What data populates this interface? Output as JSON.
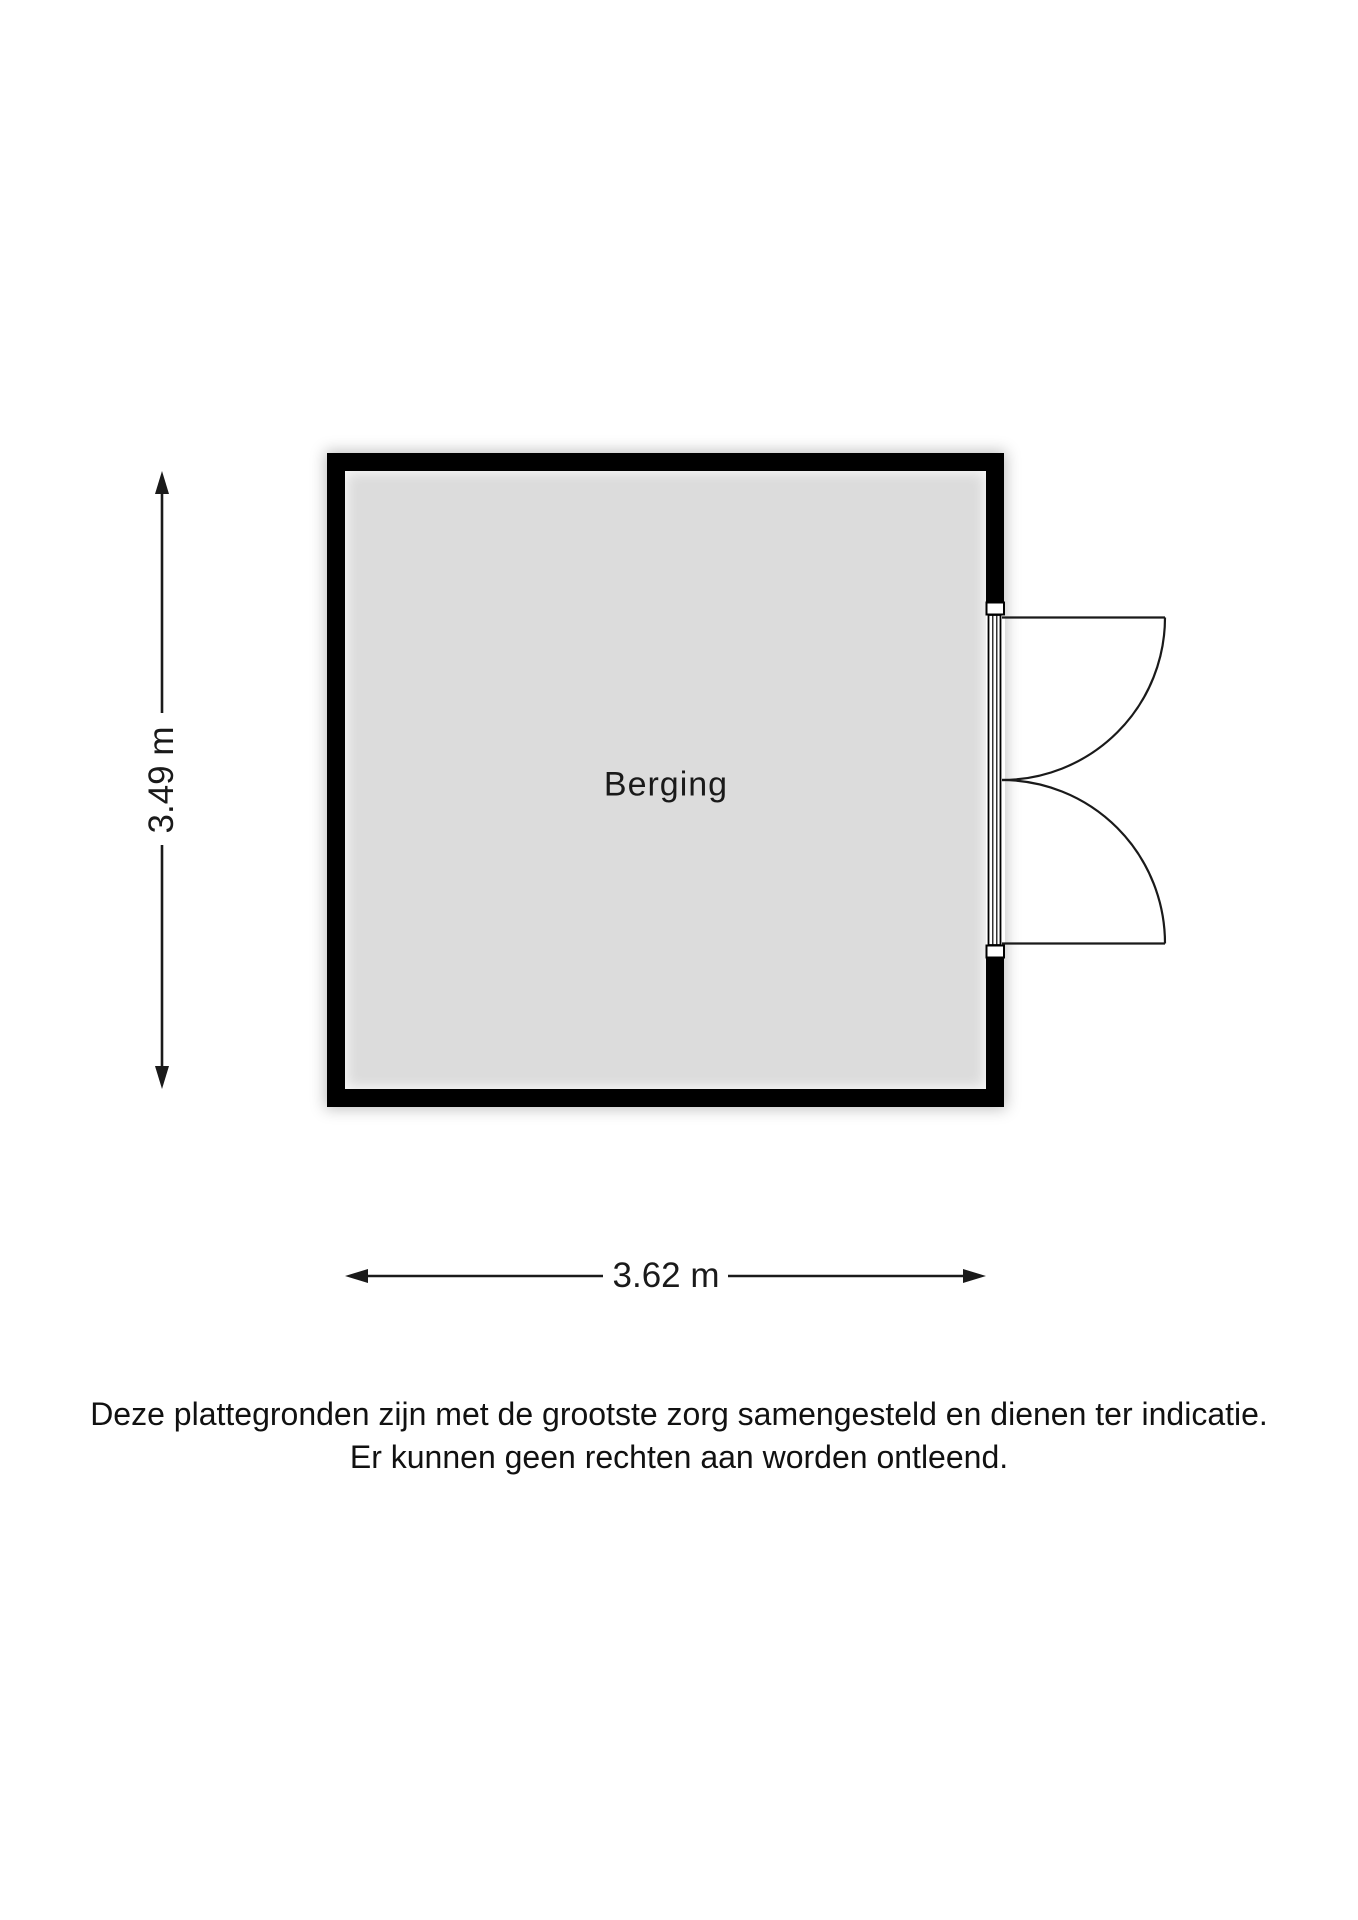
{
  "floorplan": {
    "room": {
      "label": "Berging",
      "height_label": "3.49 m",
      "width_label": "3.62 m"
    },
    "disclaimer": {
      "line1": "Deze plattegronden zijn met de grootste zorg samengesteld en dienen ter indicatie.",
      "line2": "Er kunnen geen rechten aan worden ontleend."
    },
    "colors": {
      "wall": "#000000",
      "floor": "#dcdcdc",
      "annotation": "#1a1a1a",
      "background": "#ffffff"
    }
  }
}
